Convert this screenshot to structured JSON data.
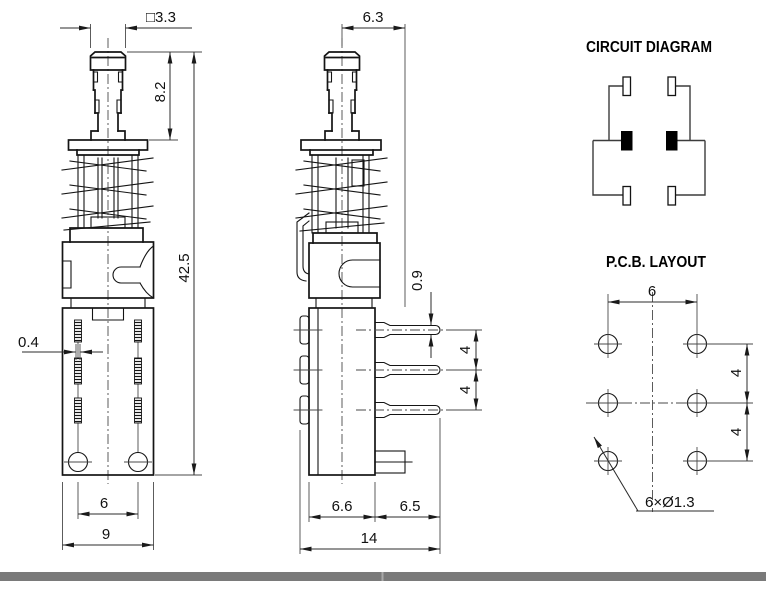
{
  "front_view": {
    "dim_square": "□3.3",
    "dim_plunger_height": "8.2",
    "dim_total_height": "42.5",
    "dim_terminal_thickness": "0.4",
    "dim_hole_spacing": "6",
    "dim_body_width": "9"
  },
  "side_view": {
    "dim_top_width": "6.3",
    "dim_pin_thickness": "0.9",
    "dim_pin_pitch_upper": "4",
    "dim_pin_pitch_lower": "4",
    "dim_body_depth": "6.6",
    "dim_pin_length": "6.5",
    "dim_total_depth": "14"
  },
  "circuit_diagram": {
    "title": "CIRCUIT DIAGRAM"
  },
  "pcb_layout": {
    "title": "P.C.B. LAYOUT",
    "dim_hole_spacing_x": "6",
    "dim_hole_pitch_upper": "4",
    "dim_hole_pitch_lower": "4",
    "hole_callout": "6×Ø1.3"
  },
  "colors": {
    "line": "#141414",
    "divider_bar": "#7a7a7a"
  }
}
